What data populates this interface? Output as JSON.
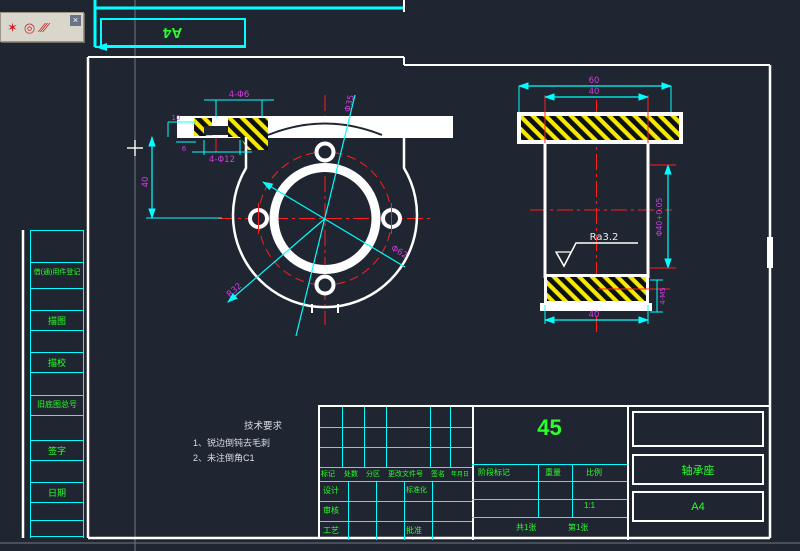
{
  "toolbar": {
    "close_label": "×",
    "icon_spray": "✶",
    "icon_donut": "◎",
    "icon_hatch": "∕∕∕"
  },
  "paper": {
    "size_label": "A4"
  },
  "left_strip": {
    "rows": [
      "借(通)用件登记",
      "描图",
      "描校",
      "旧底图总号",
      "签字",
      "日期"
    ]
  },
  "technical_requirements": {
    "title": "技术要求",
    "items": [
      "1、锐边倒钝去毛刺",
      "2、未注倒角C1"
    ]
  },
  "front_view": {
    "dim_top_holes": "4-Φ6",
    "dim_counterbore": "4-Φ12",
    "dim_height": "40",
    "dim_plate_thickness": "10",
    "dim_step": "6",
    "dim_bore": "Φ35",
    "dim_bolt_circle": "Φ62",
    "dim_radius": "R32"
  },
  "section_view": {
    "dim_outer_width": "60",
    "dim_inner_width": "40",
    "dim_bore_tolerance": "Φ40+0.05",
    "dim_tapped_holes": "4-M5",
    "dim_bottom_width": "40",
    "surface_finish": "Ra3.2"
  },
  "title_block": {
    "material": "45",
    "part_name": "轴承座",
    "paper_size": "A4",
    "rev_col_1": "标记",
    "rev_col_2": "处数",
    "rev_col_3": "分区",
    "rev_col_4": "更改文件号",
    "rev_col_5": "签名",
    "rev_col_6": "年月日",
    "role_design": "设计",
    "role_check": "审核",
    "role_process": "工艺",
    "role_standard": "标准化",
    "role_approve": "批准",
    "stage_label": "阶段标记",
    "weight_label": "重量",
    "scale_label": "比例",
    "scale_value": "1:1",
    "sheet_total": "共1张",
    "sheet_number": "第1张"
  }
}
